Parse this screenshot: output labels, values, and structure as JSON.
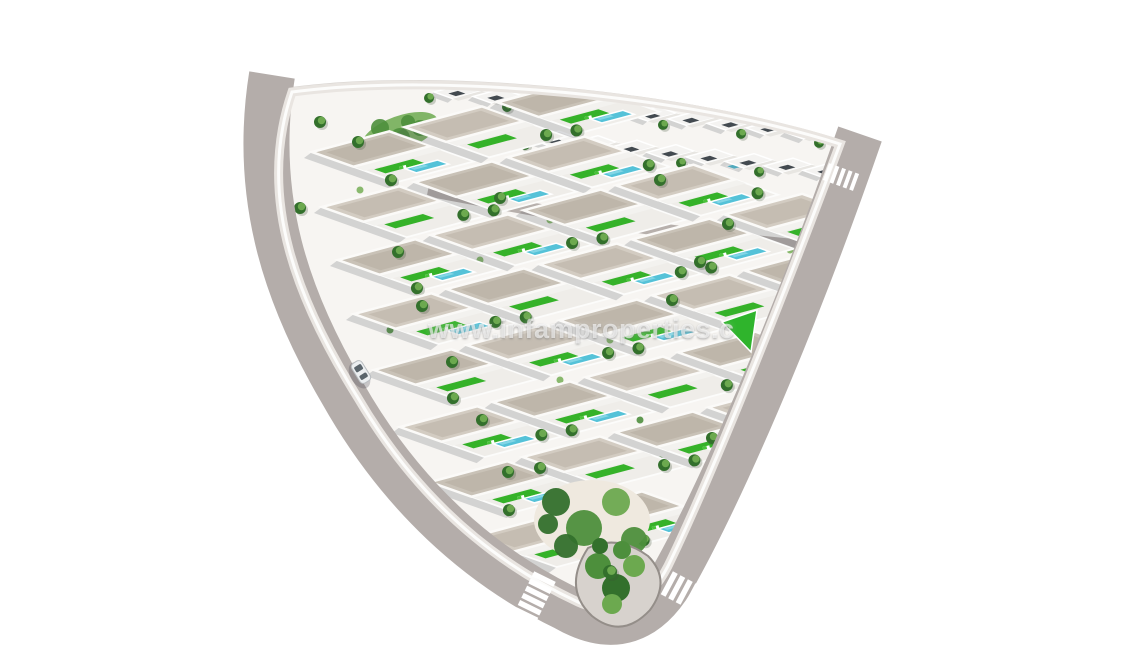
{
  "watermark": {
    "text": "www.infamproperties.c",
    "color": "#ffffff",
    "opacity": 0.62
  },
  "palette": {
    "background": "#ffffff",
    "road": "#b4adaa",
    "road_inner": "#aba4a0",
    "sidewalk": "#e9e5e1",
    "wall": "#fcfcfb",
    "top_sidewalk": "#d8d4d0",
    "internal_road": "#b7b0ac",
    "ground": "#f7f5f2",
    "plot": "#efede9",
    "roof_a": "#d3ccc2",
    "roof_b": "#c9c2b7",
    "roof_texture": "rgba(160,150,135,0.28)",
    "terrace": "#f3f2ef",
    "house_small": "#f4f3f1",
    "house_band": "#e8e6e2",
    "opening": "#434a50",
    "shadow": "rgba(70,75,85,0.20)",
    "lawn": "#35b229",
    "lawn_bright": "#2fb42c",
    "pool": "#55c2d8",
    "pool_deep": "#3fb3cd",
    "pool_light": "#8edbe8",
    "lounger": "#ffffff",
    "lounger_pad": "#49c23a",
    "palm_dark": "#33702c",
    "palm": "#4d8f3c",
    "palm_light": "#6ca94f",
    "shrub": "#7cb25e",
    "shrub_dark": "#4e8f3e",
    "sand": "#efe9df",
    "island_fill": "#d7d2cd",
    "island_edge": "#948e89",
    "crosswalk": "#ffffff",
    "car_body": "#eceff1",
    "car_glass": "#5b656c"
  },
  "scene": {
    "axes": {
      "u": [
        0.966,
        -0.259
      ],
      "v": [
        0.94,
        0.335
      ]
    },
    "interior_path": "M 292,92 C 255,200 300,305 358,398 C 416,497 492,562 578,602 Q 636,628 668,566 C 704,492 770,332 840,144 C 690,96 440,72 292,92 Z",
    "road_path": "M 272,75 C 252,200 288,300 342,392 C 400,495 478,565 566,608 Q 636,648 676,572 C 718,496 788,342 860,134",
    "road_width": 46,
    "top_sidewalk_path": "M 292,92 C 440,72 690,96 844,146",
    "internal_road_path": "M 428,190 C 560,215 700,240 852,250",
    "villa": {
      "w": 80,
      "h": 44,
      "plot_depth": 90,
      "step": 96
    },
    "villa_rows": [
      {
        "start": [
          312,
          152
        ],
        "count": 3
      },
      {
        "start": [
          322,
          207
        ],
        "count": 3
      },
      {
        "start": [
          338,
          260
        ],
        "count": 4
      },
      {
        "start": [
          354,
          314
        ],
        "count": 5
      },
      {
        "start": [
          374,
          370
        ],
        "count": 5
      },
      {
        "start": [
          400,
          427
        ],
        "count": 5
      },
      {
        "start": [
          430,
          482
        ],
        "count": 4
      },
      {
        "start": [
          472,
          537
        ],
        "count": 2
      }
    ],
    "back_house": {
      "w": 30,
      "h": 20,
      "step": 39,
      "slope": 0.115
    },
    "back_rows": [
      {
        "start": [
          434,
          92
        ],
        "count": 11
      },
      {
        "start": [
          452,
          130
        ],
        "count": 11
      }
    ],
    "green_triangle": [
      [
        722,
        322
      ],
      [
        757,
        310
      ],
      [
        751,
        352
      ]
    ],
    "corner_island": {
      "path": "M 588,548 Q 562,588 592,616 Q 622,640 650,610 Q 672,580 648,556 Q 618,534 588,548 Z",
      "circles": [
        [
          598,
          566,
          13
        ],
        [
          616,
          588,
          14
        ],
        [
          634,
          566,
          11
        ],
        [
          622,
          550,
          9
        ],
        [
          600,
          546,
          8
        ],
        [
          612,
          604,
          10
        ]
      ]
    },
    "bottom_garden": {
      "sand": [
        592,
        520,
        58,
        40
      ],
      "circles": [
        [
          556,
          502,
          14
        ],
        [
          584,
          528,
          18
        ],
        [
          616,
          502,
          14
        ],
        [
          566,
          546,
          12
        ],
        [
          634,
          540,
          13
        ],
        [
          604,
          560,
          12
        ],
        [
          548,
          524,
          10
        ]
      ]
    },
    "topleft_garden": {
      "ellipse": [
        400,
        133,
        40,
        17,
        -20
      ],
      "circles": [
        [
          380,
          128,
          9
        ],
        [
          400,
          138,
          10
        ],
        [
          420,
          128,
          8
        ],
        [
          408,
          122,
          7
        ]
      ]
    },
    "palms": [
      [
        320,
        122
      ],
      [
        358,
        142
      ],
      [
        300,
        208
      ],
      [
        398,
        252
      ],
      [
        422,
        306
      ],
      [
        452,
        362
      ],
      [
        482,
        420
      ],
      [
        508,
        472
      ],
      [
        540,
        468
      ],
      [
        672,
        300
      ],
      [
        700,
        262
      ],
      [
        728,
        224
      ],
      [
        758,
        366
      ],
      [
        712,
        438
      ],
      [
        660,
        180
      ],
      [
        500,
        198
      ]
    ],
    "shrubs": [
      [
        430,
        250
      ],
      [
        520,
        300
      ],
      [
        610,
        340
      ],
      [
        690,
        380
      ],
      [
        470,
        330
      ],
      [
        560,
        380
      ],
      [
        640,
        420
      ],
      [
        520,
        430
      ],
      [
        590,
        470
      ],
      [
        450,
        520
      ],
      [
        610,
        230
      ],
      [
        700,
        200
      ],
      [
        750,
        300
      ],
      [
        790,
        250
      ],
      [
        360,
        190
      ],
      [
        390,
        330
      ],
      [
        480,
        260
      ],
      [
        550,
        220
      ],
      [
        660,
        460
      ],
      [
        700,
        330
      ]
    ],
    "crosswalks": [
      {
        "c": [
          535,
          597
        ],
        "bar_angle": 26,
        "march_angle": -64,
        "n": 6,
        "len": 24,
        "bw": 5.5,
        "gap": 2.5
      },
      {
        "c": [
          688,
          594
        ],
        "bar_angle": -62,
        "march_angle": 28,
        "n": 6,
        "len": 26,
        "bw": 5.5,
        "gap": 3
      },
      {
        "c": [
          841,
          177
        ],
        "bar_angle": -70,
        "march_angle": 20,
        "n": 5,
        "len": 18,
        "bw": 4,
        "gap": 3
      }
    ],
    "car": {
      "pos": [
        361,
        372
      ],
      "angle": 58,
      "w": 12,
      "len": 23
    }
  }
}
